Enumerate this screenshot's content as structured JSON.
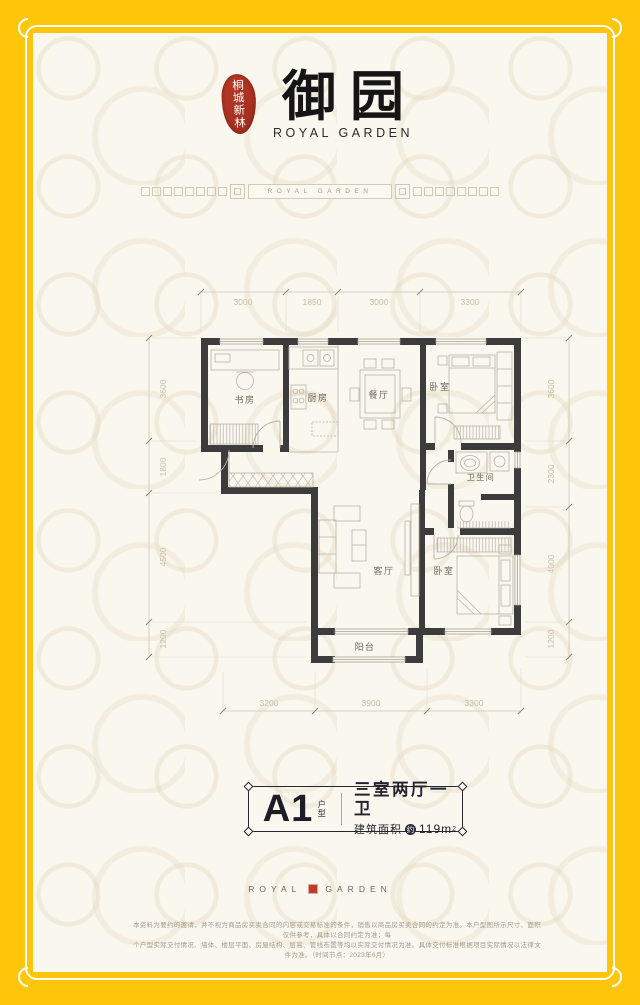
{
  "logo": {
    "seal": "桐城新林",
    "title": "御园",
    "subtitle": "ROYAL GARDEN"
  },
  "band": {
    "label": "ROYAL GARDEN"
  },
  "plan": {
    "rooms": {
      "study": "书房",
      "kitchen": "厨房",
      "dining": "餐厅",
      "bedroom_top": "卧室",
      "bathroom": "卫生间",
      "living": "客厅",
      "bedroom_bottom": "卧室",
      "balcony": "阳台"
    },
    "dims": {
      "top": [
        "3000",
        "1850",
        "3000",
        "3300"
      ],
      "left": [
        "3600",
        "1800",
        "4500",
        "1200"
      ],
      "right": [
        "3600",
        "2300",
        "4000",
        "1200"
      ],
      "bottom": [
        "3200",
        "3900",
        "3300"
      ]
    }
  },
  "unit": {
    "code": "A1",
    "code_label": "户型",
    "layout": "三室两厅一卫",
    "area_prefix": "建筑面积",
    "area_badge": "约",
    "area_value": "119m",
    "area_exp": "2"
  },
  "footer": {
    "brand_left": "ROYAL",
    "brand_right": "GARDEN",
    "disclaimer1": "本资料为要约的邀请，并不视为商品房买卖合同的内容或交易标准的条件，销售以商品房买卖合同的约定为准。本户型图所示尺寸、面积仅供参考，具体以合同约定为准；每",
    "disclaimer2": "个户型实际交付情况、墙体、楼层平面、房屋结构、层高、管线布置等均以实际交付情况为准。具体交付标准根据项目实际情况以法律文件为准。（时间节点：2023年6月）"
  }
}
